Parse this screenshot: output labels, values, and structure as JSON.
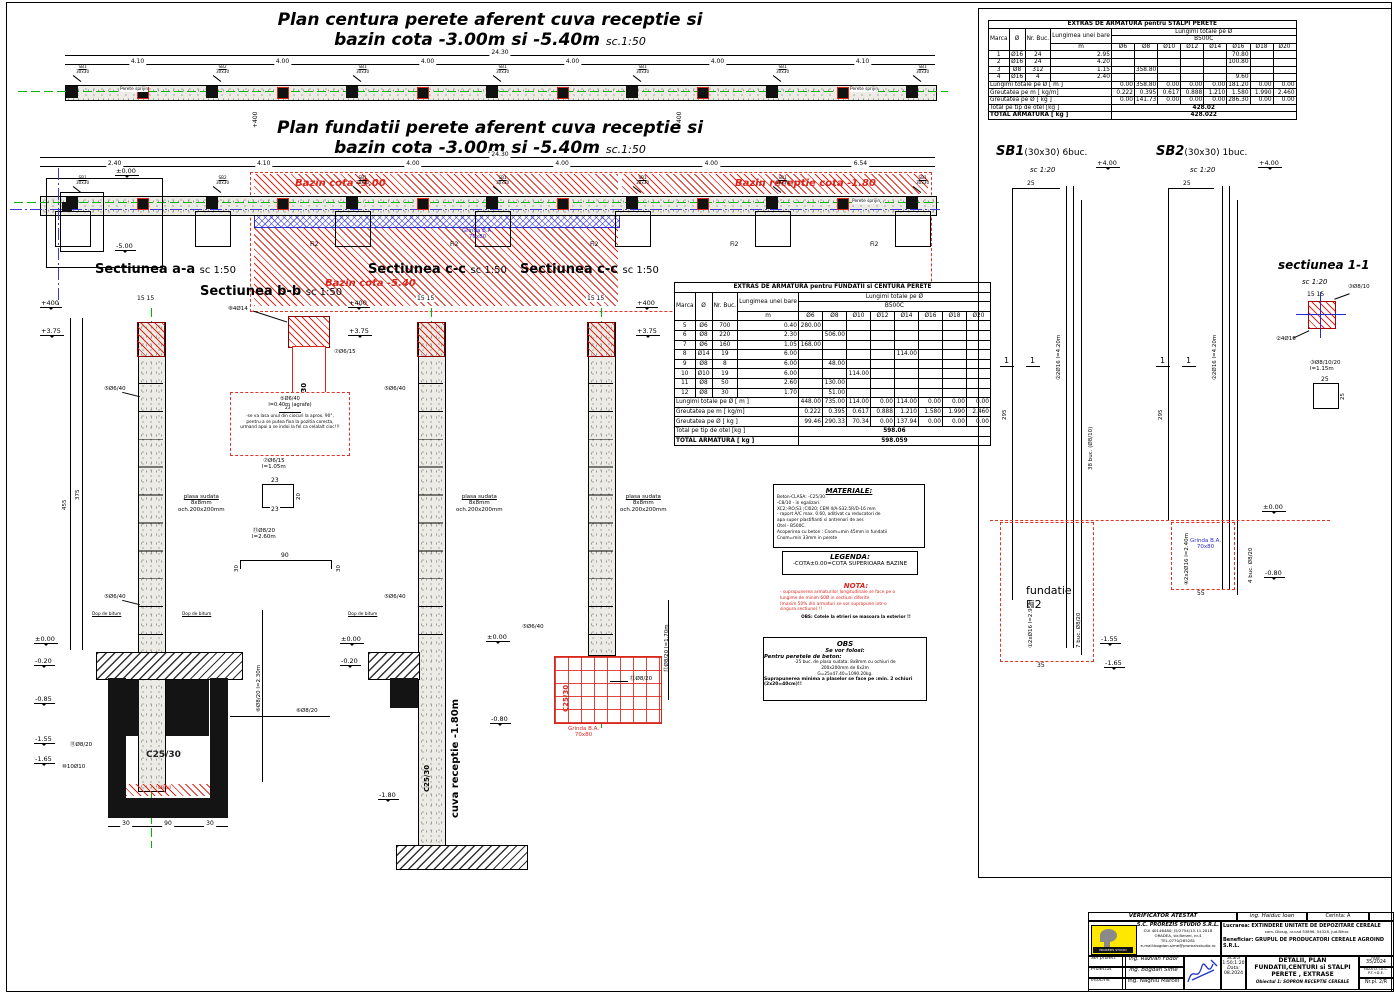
{
  "plan1": {
    "t1": "Plan centura perete aferent cuva receptie si",
    "t2": "bazin cota -3.00m si -5.40m",
    "sc": "sc.1:50",
    "total": "24.30",
    "dims": [
      "4.10",
      "4.00",
      "4.00",
      "4.00",
      "4.00",
      "4.10"
    ],
    "columns": [
      "SB1",
      "SB2",
      "SB1",
      "SB1",
      "SB1",
      "SB1",
      "SB1"
    ],
    "colsize": "30x30",
    "perete": "Perete sprijin",
    "lv400": "+400"
  },
  "plan2": {
    "t1": "Plan fundatii perete aferent cuva receptie si",
    "t2": "bazin cota -3.00m si -5.40m",
    "sc": "sc.1:50",
    "total": "24.30",
    "dims": [
      "2.40",
      "4.10",
      "4.00",
      "4.00",
      "4.00",
      "6.54"
    ],
    "columns": [
      "SB1",
      "SB2",
      "SB1",
      "SB1",
      "SB1",
      "SB1",
      "SB1"
    ],
    "colsize": "30x30",
    "perete": "Perete sprijin",
    "bazin300": "Bazin cota -3.00",
    "bazinrec": "Bazin receptie cota -1.80",
    "bazin540": "Bazin cota -5.40",
    "grinda": "Grinda B.A.",
    "grinda2": "70x80",
    "fi2": "Fi2",
    "lv0": "±0.00",
    "lvm5": "-5.00"
  },
  "sec": {
    "a": "Sectiunea a-a",
    "b": "Sectiunea b-b",
    "c": "Sectiunea c-c",
    "sc": "sc 1:50",
    "lv400": "+400",
    "lv375": "+3.75",
    "lv0": "±0.00",
    "lv020": "-0.20",
    "lv085": "-0.85",
    "lv155": "-1.55",
    "lv165": "-1.65",
    "lv080": "-0.80",
    "lv180": "-1.80",
    "m5": "⑤Ø6/40",
    "m6": "⑥Ø8/20",
    "m6v": "⑥Ø8/20 l=2.30m",
    "m8": "⑧4Ø14",
    "m7": "⑦Ø6/15",
    "m10": "⑩10Ø10",
    "m11": "⑪Ø8/20",
    "m12": "⑫Ø8/20",
    "m12v": "⑫Ø8/20 l=1.70m",
    "plasa1": "plasa sudata",
    "plasa2": "8x8mm",
    "plasa3": "och.200x200mm",
    "dop": "Dop de bitum",
    "c2530": "C25/30",
    "c810": "C8/10",
    "cuva": "cuva receptie -1.80m",
    "grinda": "Grinda B.A.",
    "grinda2": "70x80",
    "agrT": "⑤Ø6/40",
    "agrS": "l=0.40m (agrafe)",
    "agr1": "-se va lasa unul din ciocuri la aprox. 90°,",
    "agr2": "pentru a se putea fixa la pozitia corecta,",
    "agr3": "urmand apoi a se indoi la fel ca celalalt cioc!!!",
    "agrD": "23",
    "m7T": "⑦Ø6/15",
    "m7S": "l=1.05m",
    "m7d1": "23",
    "m7d2": "20",
    "m11T": "⑪Ø8/20",
    "m11S": "l=2.60m",
    "m11d1": "90",
    "m11d2": "30",
    "d1515": "15  15",
    "d375": "375",
    "d455": "455",
    "d90": "90",
    "d30": "30"
  },
  "t1": {
    "title": "EXTRAS DE ARMATURA pentru STALPI PERETE",
    "header": {
      "marca": "Marca",
      "d": "Ø",
      "nr": "Nr. Buc.",
      "lung": "Lungimea unei bare",
      "m": "m",
      "lungimi": "Lungimi totale pe Ø",
      "otel": "B500C",
      "diams": [
        "Ø6",
        "Ø8",
        "Ø10",
        "Ø12",
        "Ø14",
        "Ø16",
        "Ø18",
        "Ø20"
      ]
    },
    "rows": [
      [
        "1",
        "Ø16",
        "24",
        "2.95",
        "",
        "",
        "",
        "",
        "",
        "70.80",
        "",
        ""
      ],
      [
        "2",
        "Ø16",
        "24",
        "4.20",
        "",
        "",
        "",
        "",
        "",
        "100.80",
        "",
        ""
      ],
      [
        "3",
        "Ø8",
        "312",
        "1.15",
        "",
        "358.80",
        "",
        "",
        "",
        "",
        "",
        ""
      ],
      [
        "4",
        "Ø16",
        "4",
        "2.40",
        "",
        "",
        "",
        "",
        "",
        "9.60",
        "",
        ""
      ]
    ],
    "label_m": "Lungimi totale pe Ø [ m ]",
    "values_m": [
      "0.00",
      "358.80",
      "0.00",
      "0.00",
      "0.00",
      "181.20",
      "0.00",
      "0.00"
    ],
    "label_kgm": "Greutatea pe m [ kg/m]",
    "values_kgm": [
      "0.222",
      "0.395",
      "0.617",
      "0.888",
      "1.210",
      "1.580",
      "1.990",
      "2.460"
    ],
    "label_kgd": "Greutatea pe Ø [ kg ]",
    "values_kgd": [
      "0.00",
      "141.73",
      "0.00",
      "0.00",
      "0.00",
      "286.30",
      "0.00",
      "0.00"
    ],
    "label_total": "Total pe tip de otel [kg ]",
    "total": "428.02",
    "label_grand": "TOTAL ARMATURA [ kg ]",
    "grand": "428.022"
  },
  "t2": {
    "title": "EXTRAS DE ARMATURA pentru FUNDATII si CENTURA PERETE",
    "header": {
      "marca": "Marca",
      "d": "Ø",
      "nr": "Nr. Buc.",
      "lung": "Lungimea unei bare",
      "m": "m",
      "lungimi": "Lungimi totale pe Ø",
      "otel": "B500C",
      "diams": [
        "Ø6",
        "Ø8",
        "Ø10",
        "Ø12",
        "Ø14",
        "Ø16",
        "Ø18",
        "Ø20"
      ]
    },
    "rows": [
      [
        "5",
        "Ø6",
        "700",
        "0.40",
        "280.00",
        "",
        "",
        "",
        "",
        "",
        "",
        ""
      ],
      [
        "6",
        "Ø8",
        "220",
        "2.30",
        "",
        "506.00",
        "",
        "",
        "",
        "",
        "",
        ""
      ],
      [
        "7",
        "Ø6",
        "160",
        "1.05",
        "168.00",
        "",
        "",
        "",
        "",
        "",
        "",
        ""
      ],
      [
        "8",
        "Ø14",
        "19",
        "6.00",
        "",
        "",
        "",
        "",
        "114.00",
        "",
        "",
        ""
      ],
      [
        "9",
        "Ø8",
        "8",
        "6.00",
        "",
        "48.00",
        "",
        "",
        "",
        "",
        "",
        ""
      ],
      [
        "10",
        "Ø10",
        "19",
        "6.00",
        "",
        "",
        "114.00",
        "",
        "",
        "",
        "",
        ""
      ],
      [
        "11",
        "Ø8",
        "50",
        "2.60",
        "",
        "130.00",
        "",
        "",
        "",
        "",
        "",
        ""
      ],
      [
        "12",
        "Ø8",
        "30",
        "1.70",
        "",
        "51.00",
        "",
        "",
        "",
        "",
        "",
        ""
      ]
    ],
    "label_m": "Lungimi totale pe Ø [ m ]",
    "values_m": [
      "448.00",
      "735.00",
      "114.00",
      "0.00",
      "114.00",
      "0.00",
      "0.00",
      "0.00"
    ],
    "label_kgm": "Greutatea pe m [ kg/m]",
    "values_kgm": [
      "0.222",
      "0.395",
      "0.617",
      "0.888",
      "1.210",
      "1.580",
      "1.990",
      "2.460"
    ],
    "label_kgd": "Greutatea pe Ø [ kg ]",
    "values_kgd": [
      "99.46",
      "290.33",
      "70.34",
      "0.00",
      "137.94",
      "0.00",
      "0.00",
      "0.00"
    ],
    "label_total": "Total pe tip de otel [kg ]",
    "total": "598.06",
    "label_grand": "TOTAL ARMATURA [ kg ]",
    "grand": "598.059"
  },
  "mat": {
    "title": "MATERIALE:",
    "lines": [
      "Beton-CLASA:   -C25/30.",
      "        -C8/10 - in egalizari.",
      "    XC2;-RO;S3 ;Cl020; CEM II/A-S32.5R/D-16 mm",
      "     - raport A/C max. 0.60, aditivat cu reducatori de",
      "        apa super plastifianti si antrenori de aer.",
      "Otel     - B500C.",
      "Acoperirea cu beton : Cnom=min 45mm in fundatii",
      "                Cnom=min 33mm in perete"
    ]
  },
  "leg": {
    "title": "LEGENDA:",
    "line": "-COTA±0.00=COTA SUPERIOARA BAZINE"
  },
  "nota": {
    "title": "NOTA:",
    "lines": [
      "- suprapunerea armaturilor longitudinale se face pe o",
      "lungime de minim 60Ø in sectiuni diferite",
      "(maxim 50% din armaturi se vor suprapune intr-o",
      "singura sectiune) !!"
    ],
    "obs": "OBS: Cotele la etrieri se masoara la exterior !!"
  },
  "obs": {
    "title": "OBS",
    "l1": "Se vor folosi:",
    "l2": "Pentru peretele de beton:",
    "lines": [
      "-25 buc. de plasa sudata. 8x8mm cu ochiuri de",
      "200x200mm de 6x2m",
      "G=25x47.40=1090.20kg."
    ],
    "b1": "Suprapunerea minima a plaselor se face pe :min. 2 ochiuri",
    "b2": "(2x20=40cm)!!"
  },
  "rp": {
    "sb1": "SB1",
    "sb1i": "(30x30) 6buc.",
    "sb2": "SB2",
    "sb2i": "(30x30) 1buc.",
    "sc120": "sc 1:20",
    "lv4": "+4.00",
    "lv0": "±0.00",
    "lv080": "-0.80",
    "lv155": "-1.55",
    "lv165": "-1.65",
    "m1": "①2xØ16 l=2.95m",
    "m2": "②2Ø16 l=4.20m",
    "m4": "④2x2Ø16 l=2.40m",
    "st1": "7 buc. Ø8/20",
    "st2": "38 buc. (Ø8/10)",
    "st3": "4 buc. Ø8/20",
    "fund1": "fundatie",
    "fund2": "Fi2",
    "gr1": "Grinda B.A.",
    "gr2": "70x80",
    "cut": "1",
    "d25": "25",
    "d35": "35",
    "d55": "55",
    "d295": "295",
    "s11": "sectiunea 1-1",
    "s11sc": "sc 1:20",
    "s11m3": "③Ø8/10",
    "s11m2": "②4Ø16",
    "s11m3v": "③Ø8/10/20",
    "s11m3v2": "l=1.15m",
    "d1515": "15  15"
  },
  "tb": {
    "verif": "VERIFICATOR ATESTAT",
    "vname": "ing. Haiduc Ioan",
    "cerinta": "Cerinta:  A",
    "logo": "PROREZIS STUDIO",
    "co1": "S.C. PROREZIS STUDIO S.R.L.",
    "co2": "CUI 40146480; J5/2754/13.11.2018",
    "co3": "ORADEA, str.Berzei, nr.4",
    "co4": "TEL.0770/285281",
    "co5": "e-mail:bogdan.sime@prorezisstudio.ro",
    "lucL": "Lucrarea:",
    "luc": "EXTINDERE UNITATE DE DEPOZITARE CEREALE",
    "luc2": "com. Diosig, nr.cad 53896, 54328, jud.Bihor.",
    "benL": "Beneficiar:",
    "ben": "GRUPUL DE PRODUCATORI CEREALE AGROIND S.R.L.",
    "r1": "Sef proiect",
    "n1": "ing. Razvan Fodor",
    "r2": "Proiectat",
    "n2": "ing. Bogdan Sime",
    "r3": "Intocmit",
    "n3": "ing. Naghiu Marcel",
    "scaraL": "Scara",
    "scara": "1:50;1:20",
    "dataL": "Data:",
    "data": "08.2024",
    "pl1": "DETALII, PLAN",
    "pl2": "FUNDATII,CENTURI si STALPI",
    "pl3": "PERETE , EXTRASE",
    "ob": "Obiectul 1: SOPRON RECEPTIE CEREALE",
    "nrprL": "nr.pr.",
    "nrpr": "35/2024",
    "faza1": "FAZA D.T.A.C.",
    "faza2": "P.T.+D.E.",
    "nrpl": "Nr.pl. 2/R"
  }
}
